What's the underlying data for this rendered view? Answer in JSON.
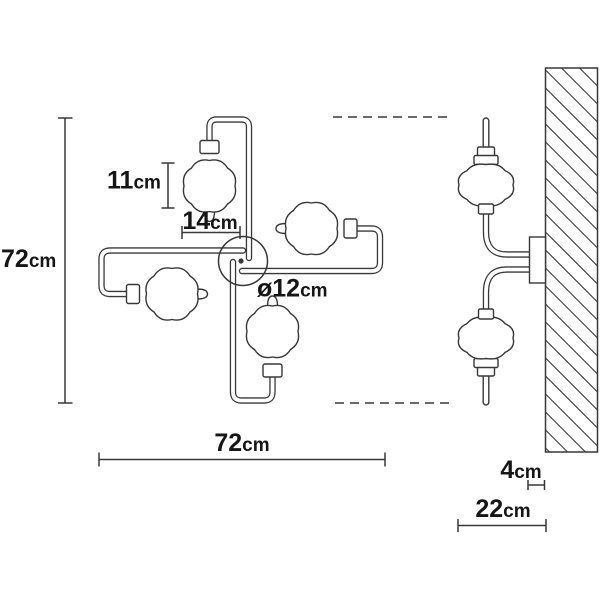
{
  "drawing": {
    "labels": {
      "height": {
        "value": "72",
        "unit": "cm"
      },
      "width": {
        "value": "72",
        "unit": "cm"
      },
      "bulb_height": {
        "value": "11",
        "unit": "cm"
      },
      "arm_offset": {
        "value": "14",
        "unit": "cm"
      },
      "canopy_diameter": {
        "value": "ø12",
        "unit": "cm"
      },
      "plate_depth": {
        "value": "4",
        "unit": "cm"
      },
      "projection": {
        "value": "22",
        "unit": "cm"
      }
    },
    "colors": {
      "line": "#383838",
      "text": "#161616",
      "background": "#ffffff"
    }
  }
}
